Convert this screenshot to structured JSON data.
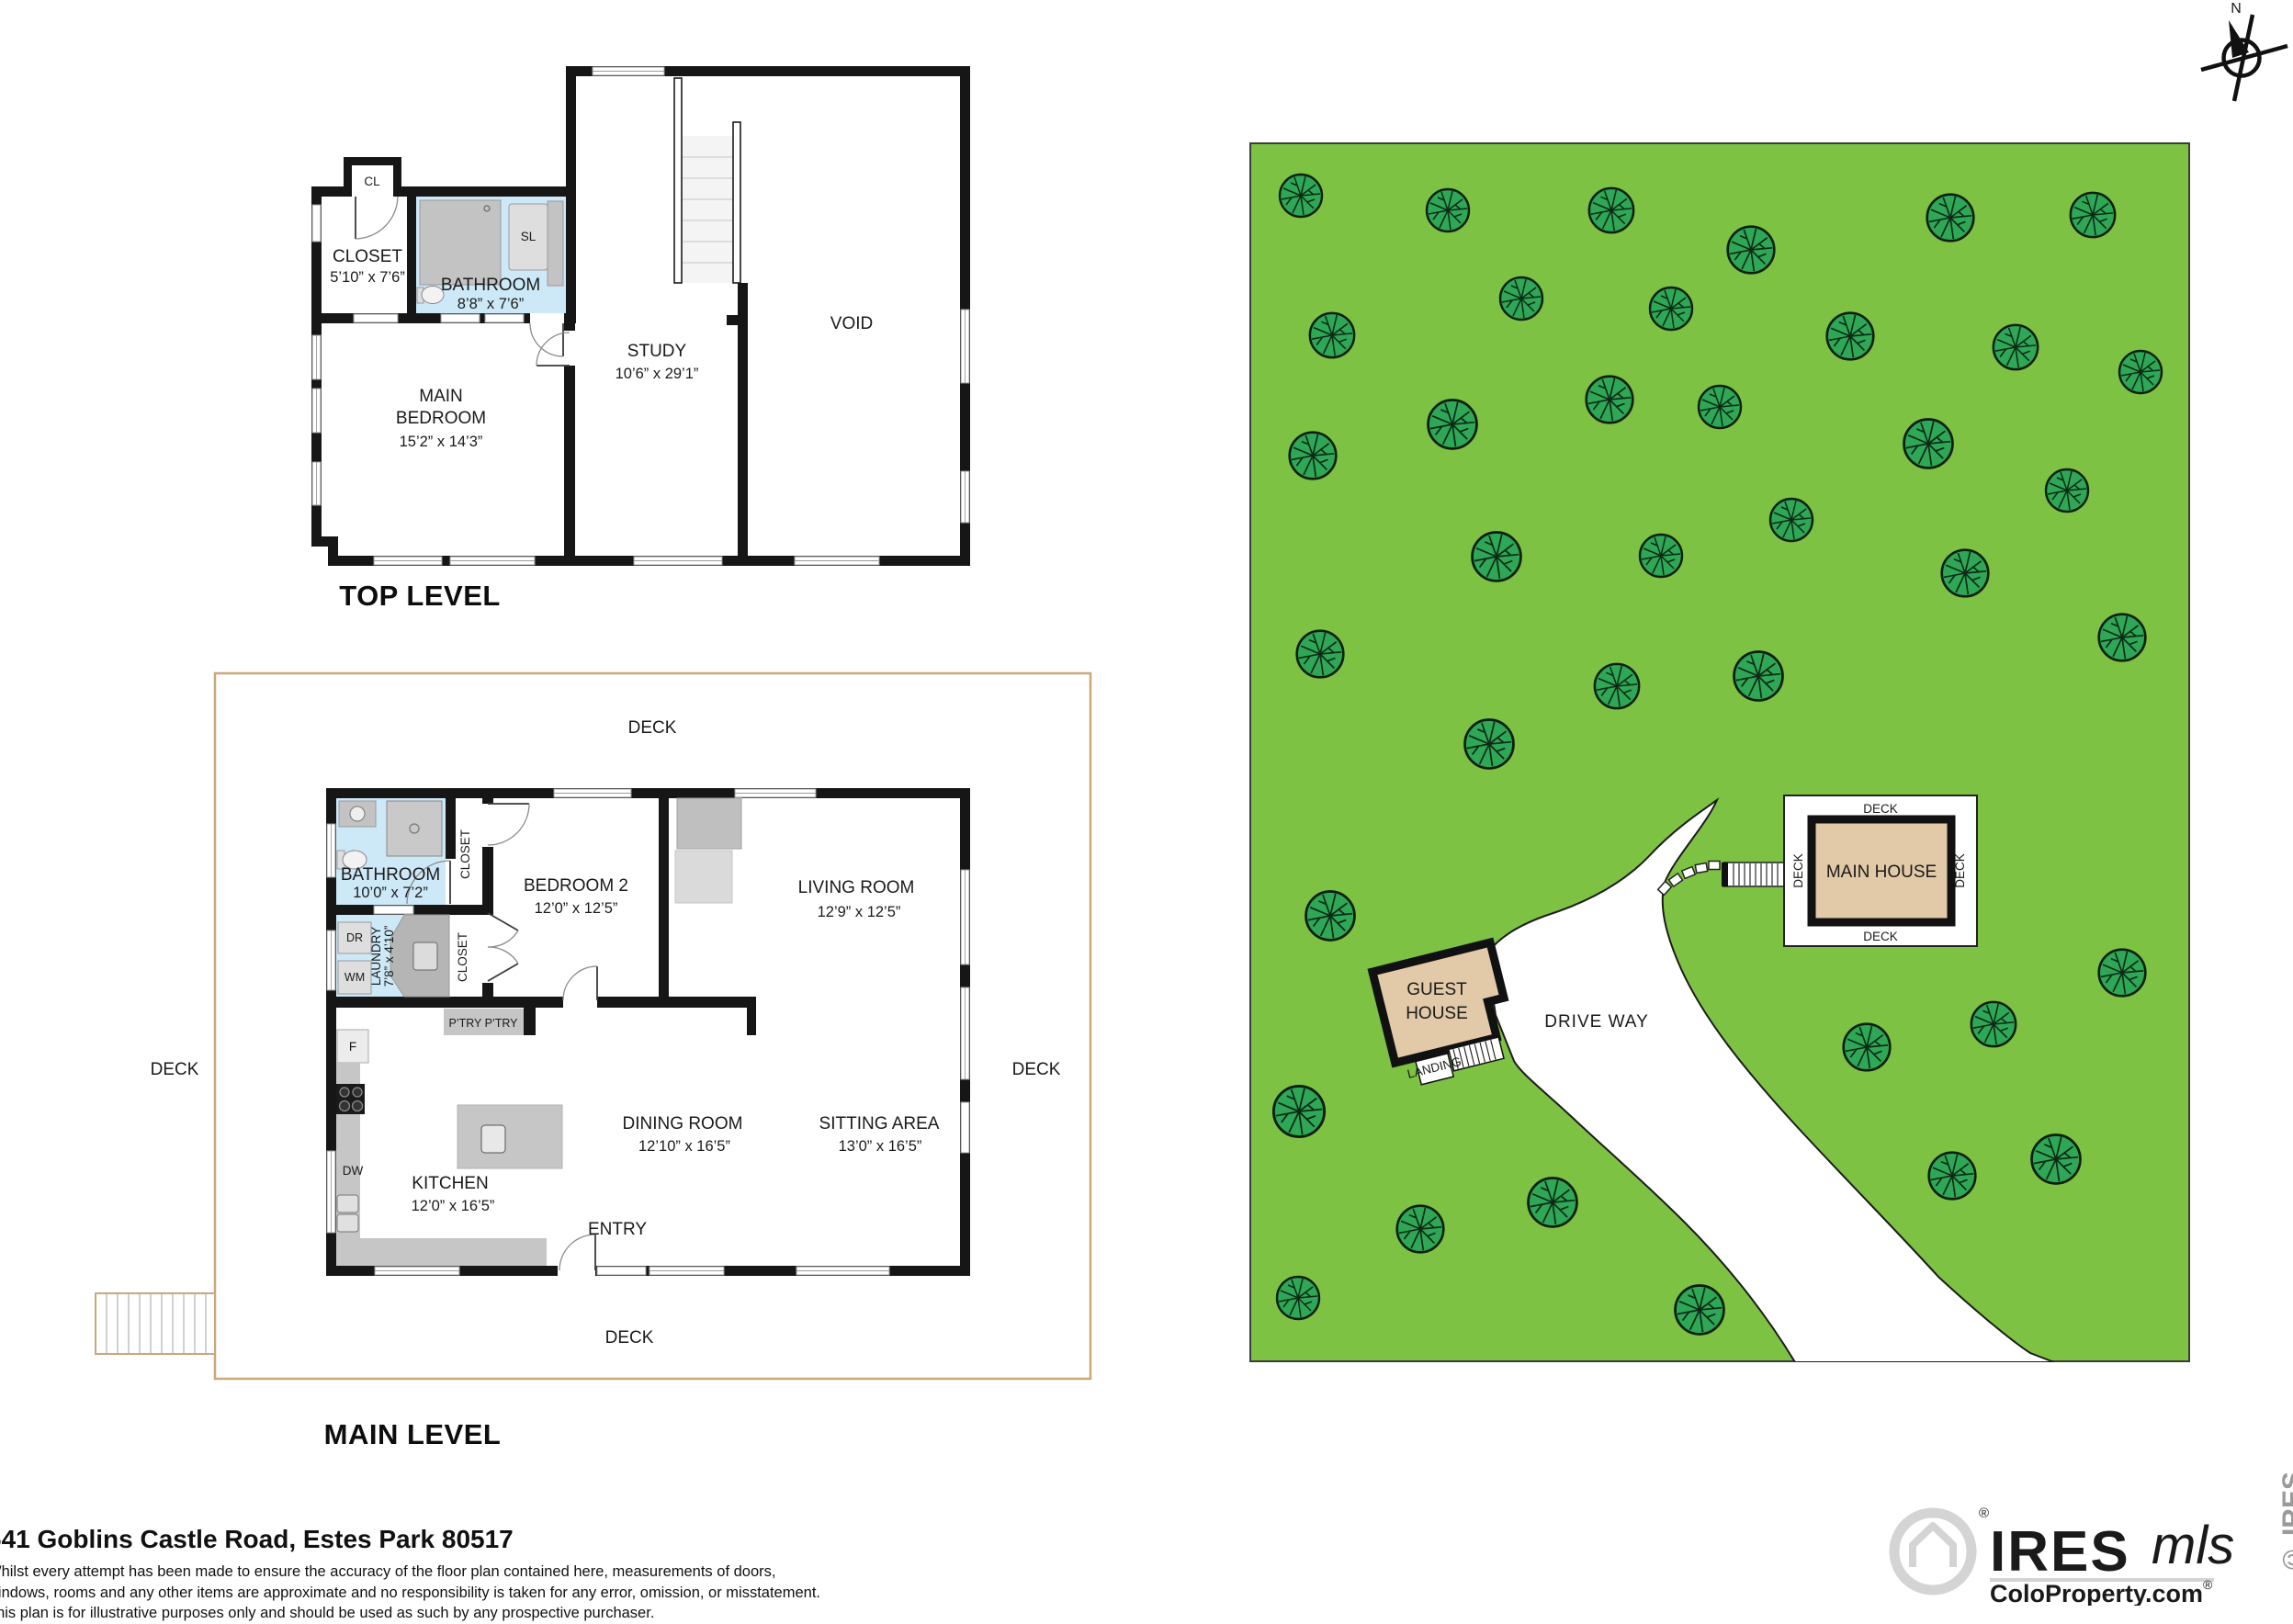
{
  "colors": {
    "grass": "#7DC242",
    "tree": "#2EA757",
    "house_tan": "#E2C9A8",
    "bath_blue": "#CDE9F8",
    "wall": "#161616",
    "deck_trim": "#C8A87C",
    "watermark": "#D4D4D4"
  },
  "compass": {
    "north_label": "N"
  },
  "top_level": {
    "title": "TOP LEVEL",
    "cl_label": "CL",
    "closet_name": "CLOSET",
    "closet_dims": "5’10” x 7’6”",
    "bathroom_name": "BATHROOM",
    "bathroom_dims": "8’8” x 7’6”",
    "sl_label": "SL",
    "bedroom_line1": "MAIN",
    "bedroom_line2": "BEDROOM",
    "bedroom_dims": "15’2” x 14’3”",
    "study_name": "STUDY",
    "study_dims": "10’6” x 29’1”",
    "void_label": "VOID"
  },
  "main_level": {
    "title": "MAIN LEVEL",
    "deck_label": "DECK",
    "bathroom_name": "BATHROOM",
    "bathroom_dims": "10’0” x 7’2”",
    "closet_label": "CLOSET",
    "laundry_name": "LAUNDRY",
    "laundry_dims": "7’8” x 4’10”",
    "dryer_label": "DR",
    "washer_label": "WM",
    "fridge_label": "F",
    "dishwasher_label": "DW",
    "pantry_label": "P’TRY  P’TRY",
    "bedroom2_name": "BEDROOM 2",
    "bedroom2_dims": "12’0” x 12’5”",
    "living_name": "LIVING ROOM",
    "living_dims": "12’9” x 12’5”",
    "dining_name": "DINING ROOM",
    "dining_dims": "12’10” x 16’5”",
    "sitting_name": "SITTING AREA",
    "sitting_dims": "13’0” x 16’5”",
    "kitchen_name": "KITCHEN",
    "kitchen_dims": "12’0” x 16’5”",
    "entry_label": "ENTRY"
  },
  "site_plan": {
    "main_house_label": "MAIN HOUSE",
    "deck_label": "DECK",
    "guest_house_line1": "GUEST",
    "guest_house_line2": "HOUSE",
    "landing_label": "LANDING",
    "driveway_label": "DRIVE WAY",
    "trees": [
      [
        56,
        58,
        1
      ],
      [
        216,
        74,
        1
      ],
      [
        394,
        74,
        1.05
      ],
      [
        546,
        117,
        1.1
      ],
      [
        763,
        82,
        1.1
      ],
      [
        918,
        79,
        1.05
      ],
      [
        296,
        170,
        1
      ],
      [
        459,
        181,
        1
      ],
      [
        654,
        211,
        1.1
      ],
      [
        834,
        223,
        1.05
      ],
      [
        970,
        250,
        1
      ],
      [
        90,
        210,
        1.05
      ],
      [
        221,
        307,
        1.15
      ],
      [
        392,
        280,
        1.1
      ],
      [
        512,
        288,
        1
      ],
      [
        739,
        328,
        1.15
      ],
      [
        890,
        379,
        1
      ],
      [
        69,
        341,
        1.1
      ],
      [
        269,
        451,
        1.15
      ],
      [
        448,
        450,
        1
      ],
      [
        590,
        411,
        1
      ],
      [
        779,
        469,
        1.1
      ],
      [
        77,
        557,
        1.1
      ],
      [
        400,
        592,
        1.05
      ],
      [
        554,
        581,
        1.15
      ],
      [
        950,
        539,
        1.1
      ],
      [
        261,
        655,
        1.15
      ],
      [
        88,
        842,
        1.15
      ],
      [
        54,
        1055,
        1.2
      ],
      [
        53,
        1258,
        1
      ],
      [
        186,
        1183,
        1.1
      ],
      [
        330,
        1154,
        1.15
      ],
      [
        490,
        1271,
        1.15
      ],
      [
        672,
        985,
        1.1
      ],
      [
        810,
        960,
        1.05
      ],
      [
        950,
        904,
        1.1
      ],
      [
        765,
        1125,
        1.1
      ],
      [
        878,
        1107,
        1.15
      ]
    ]
  },
  "footer": {
    "address": "641 Goblins Castle Road, Estes Park 80517",
    "disclaimer_line1": "Whilst every attempt has been made to ensure the accuracy of the floor plan contained here, measurements of doors,",
    "disclaimer_line2": "windows, rooms and any other items are approximate and no responsibility is taken for any error, omission, or misstatement.",
    "disclaimer_line3": "This plan is for illustrative purposes only and should be used as such by any prospective purchaser."
  },
  "branding": {
    "ires": "IRES",
    "mls": "mls",
    "coloproperty": "ColoProperty.com",
    "registered": "®",
    "side_mark": "© IRES"
  }
}
